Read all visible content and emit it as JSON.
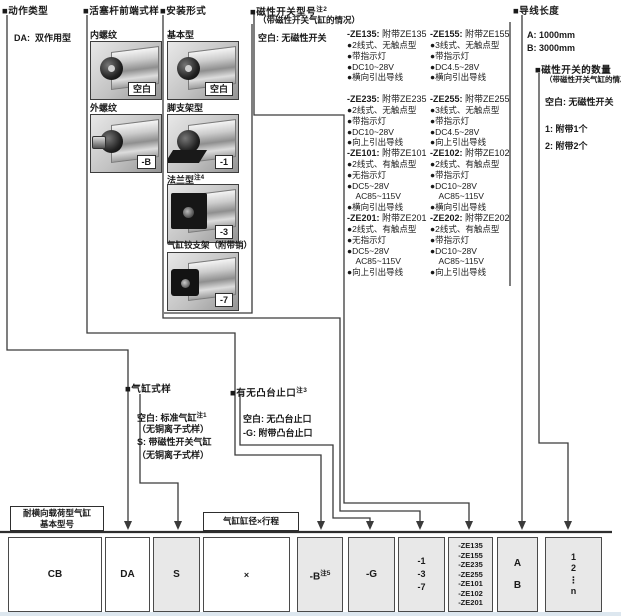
{
  "diagram": {
    "action": {
      "title": "■动作类型",
      "item_code": "DA:",
      "item_label": "双作用型"
    },
    "rod_end": {
      "title": "■活塞杆前端式样",
      "options": [
        {
          "name": "内螺纹",
          "code": "空白"
        },
        {
          "name": "外螺纹",
          "code": "-B"
        }
      ]
    },
    "mounting": {
      "title": "■安装形式",
      "options": [
        {
          "name": "基本型",
          "sup": "",
          "code": "空白"
        },
        {
          "name": "脚支架型",
          "sup": "",
          "code": "-1"
        },
        {
          "name": "法兰型",
          "sup": "注4",
          "code": "-3"
        },
        {
          "name": "气缸铰支架（附带销）",
          "sup": "",
          "code": "-7"
        }
      ]
    },
    "switch_model": {
      "title": "■磁性开关型号",
      "sup": "注2",
      "subtitle": "（带磁性开关气缸的情况）",
      "blank": "空白: 无磁性开关",
      "left": [
        {
          "code": "-ZE135:",
          "name": "附带ZE135",
          "f0": "●2线式、无触点型",
          "f1": "●带指示灯",
          "f2": "●DC10~28V",
          "f3": "●横向引出导线"
        },
        {
          "code": "-ZE235:",
          "name": "附带ZE235",
          "f0": "●2线式、无触点型",
          "f1": "●带指示灯",
          "f2": "●DC10~28V",
          "f3": "●向上引出导线"
        },
        {
          "code": "-ZE101:",
          "name": "附带ZE101",
          "f0": "●2线式、有触点型",
          "f1": "●无指示灯",
          "f2": "●DC5~28V",
          "f3": "　AC85~115V",
          "f4": "●横向引出导线"
        },
        {
          "code": "-ZE201:",
          "name": "附带ZE201",
          "f0": "●2线式、有触点型",
          "f1": "●无指示灯",
          "f2": "●DC5~28V",
          "f3": "　AC85~115V",
          "f4": "●向上引出导线"
        }
      ],
      "right": [
        {
          "code": "-ZE155:",
          "name": "附带ZE155",
          "f0": "●3线式、无触点型",
          "f1": "●带指示灯",
          "f2": "●DC4.5~28V",
          "f3": "●横向引出导线"
        },
        {
          "code": "-ZE255:",
          "name": "附带ZE255",
          "f0": "●3线式、无触点型",
          "f1": "●带指示灯",
          "f2": "●DC4.5~28V",
          "f3": "●向上引出导线"
        },
        {
          "code": "-ZE102:",
          "name": "附带ZE102",
          "f0": "●2线式、有触点型",
          "f1": "●带指示灯",
          "f2": "●DC10~28V",
          "f3": "　AC85~115V",
          "f4": "●横向引出导线"
        },
        {
          "code": "-ZE202:",
          "name": "附带ZE202",
          "f0": "●2线式、有触点型",
          "f1": "●带指示灯",
          "f2": "●DC10~28V",
          "f3": "　AC85~115V",
          "f4": "●向上引出导线"
        }
      ]
    },
    "cylinder_style": {
      "title": "■气缸式样",
      "l0": "空白: 标准气缸",
      "l0_sup": "注1",
      "l1": "（无铜离子式样）",
      "l2": "S: 带磁性开关气缸",
      "l3": "（无铜离子式样）"
    },
    "boss": {
      "title": "■有无凸台止口",
      "sup": "注3",
      "l0": "空白: 无凸台止口",
      "l1": "-G: 附带凸台止口"
    },
    "lead_wire": {
      "title": "■导线长度",
      "l0": "A:  1000mm",
      "l1": "B:  3000mm"
    },
    "switch_qty": {
      "title": "■磁性开关的数量",
      "subtitle": "（带磁性开关气缸的情况）",
      "l0": "空白: 无磁性开关",
      "l1": "1:  附带1个",
      "l2": "2:  附带2个"
    }
  },
  "bottom": {
    "base_label_line1": "耐横向载荷型气缸",
    "base_label_line2": "基本型号",
    "bore_label": "气缸缸径×行程",
    "codes": {
      "cb": "CB",
      "da": "DA",
      "s": "S",
      "x": "×",
      "b": "-B",
      "b_sup": "注5",
      "g": "-G",
      "mount0": "-1",
      "mount1": "-3",
      "mount2": "-7",
      "sw0": "-ZE135",
      "sw1": "-ZE155",
      "sw2": "-ZE235",
      "sw3": "-ZE255",
      "sw4": "-ZE101",
      "sw5": "-ZE102",
      "sw6": "-ZE201",
      "lead0": "A",
      "lead1": "B",
      "qty0": "1",
      "qty1": "2",
      "qty2": "⋮",
      "qty3": "n"
    }
  },
  "colors": {
    "line": "#3a3a3a",
    "box_gray": "#e8e8e8",
    "box_white": "#ffffff"
  }
}
